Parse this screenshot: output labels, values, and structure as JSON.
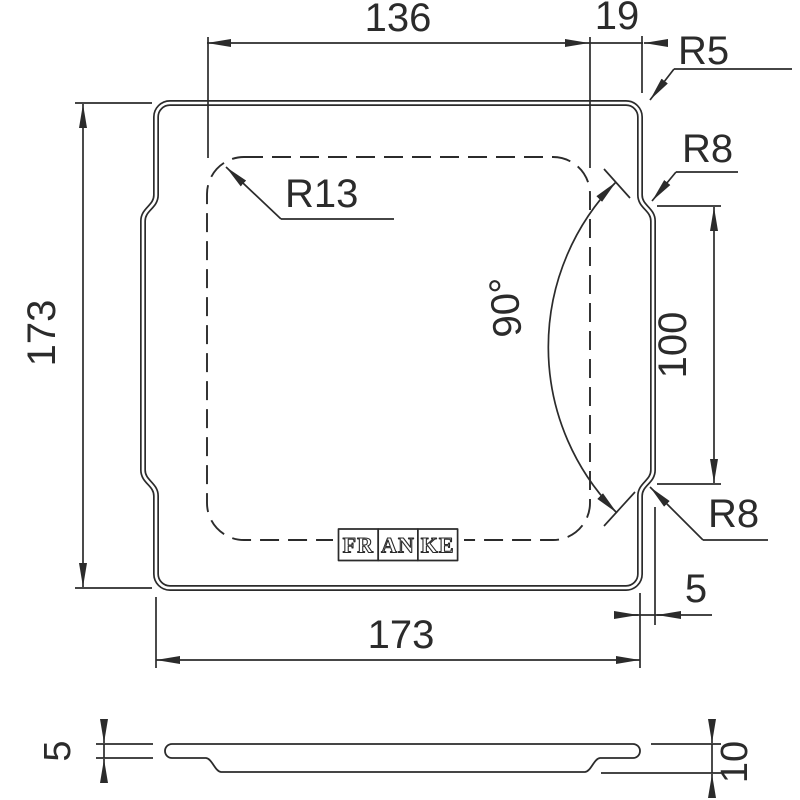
{
  "colors": {
    "line": "#2b2b2b",
    "background": "#ffffff"
  },
  "views": {
    "plan": {
      "dims": {
        "inner_width": "136",
        "corner_offset": "19",
        "outer_corner_radius": "R5",
        "notch_radius_top": "R8",
        "notch_radius_bottom": "R8",
        "inner_corner_radius": "R13",
        "angle": "90°",
        "flat_length": "100",
        "overall_height": "173",
        "overall_width": "173",
        "edge_step": "5"
      },
      "logo": {
        "brand": "FRANKE",
        "segments": [
          "FR",
          "AN",
          "KE"
        ]
      }
    },
    "profile": {
      "dims": {
        "rim_thickness": "5",
        "total_height": "10"
      }
    }
  }
}
